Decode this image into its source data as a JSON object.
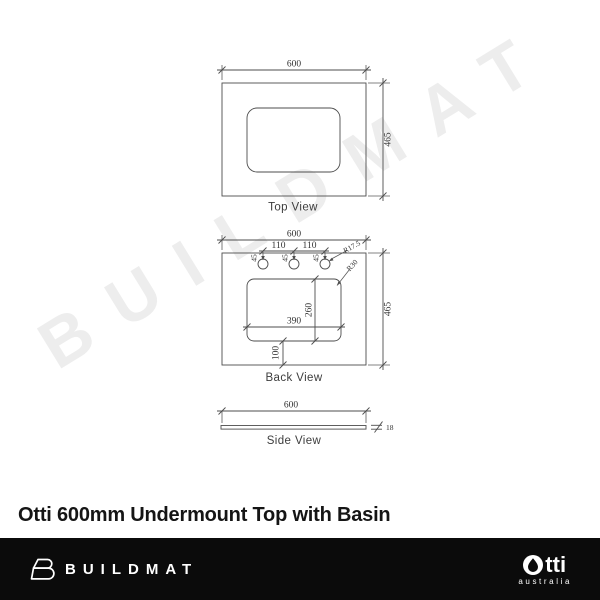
{
  "colors": {
    "watermark": "#ededed",
    "drawing_line": "#4d4d4d",
    "footer_bg": "#0b0b0b",
    "title_text": "#151515"
  },
  "watermark": {
    "text": "BUILDMAT"
  },
  "title": "Otti 600mm Undermount Top with Basin",
  "views": {
    "top": {
      "label": "Top View",
      "width": "600",
      "depth": "465"
    },
    "back": {
      "label": "Back View",
      "width": "600",
      "depth": "465",
      "hole_spacing": "110",
      "hole_offset": "45",
      "hole_radius": "R17.5",
      "corner_radius": "R30",
      "cutout_width": "390",
      "cutout_depth": "260",
      "cutout_bottom_offset": "100"
    },
    "side": {
      "label": "Side View",
      "width": "600",
      "thickness": "18"
    }
  },
  "footer": {
    "buildmat_text": "BUILDMAT",
    "otti_text": "tti",
    "otti_sub": "australia"
  }
}
